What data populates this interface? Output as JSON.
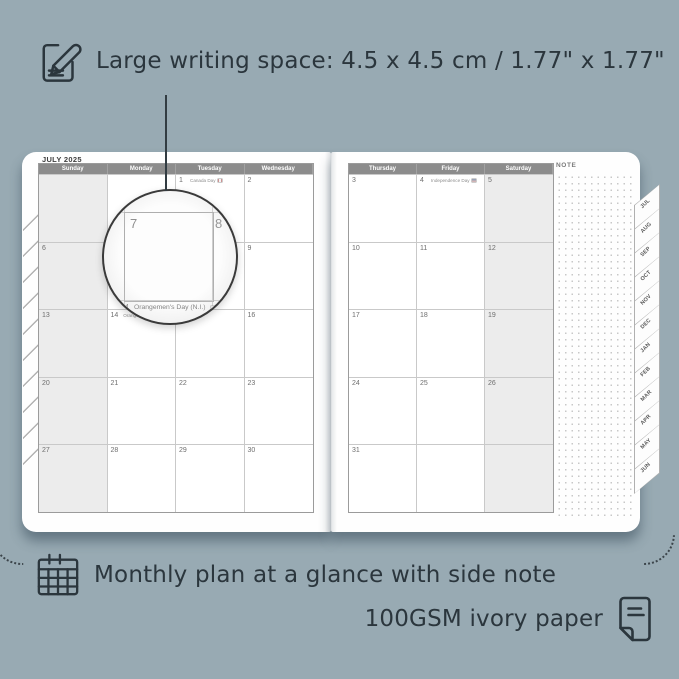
{
  "colors": {
    "background": "#98aab3",
    "ink": "#2b363d",
    "calendar_header_gray": "#8c8c8c",
    "weekend_shade": "#ececec",
    "page_white": "#fefefe"
  },
  "annotations": {
    "top": "Large writing space: 4.5 x 4.5 cm / 1.77\" x 1.77\"",
    "bottom_line1": "Monthly plan at a glance with side note",
    "bottom_line2": "100GSM ivory paper"
  },
  "icons": {
    "top": "note-pencil-icon",
    "bottom_left": "calendar-grid-icon",
    "bottom_right": "paper-icon"
  },
  "planner": {
    "left_page": {
      "title": "JULY 2025",
      "headers": [
        "Sunday",
        "Monday",
        "Tuesday",
        "Wednesday"
      ],
      "shaded_column": 0,
      "rows": [
        [
          {
            "day": ""
          },
          {
            "day": ""
          },
          {
            "day": "1",
            "holiday": "Canada Day",
            "holiday_icon": "canada-flag-icon"
          },
          {
            "day": "2"
          }
        ],
        [
          {
            "day": "6"
          },
          {
            "day": "7"
          },
          {
            "day": "8"
          },
          {
            "day": "9"
          }
        ],
        [
          {
            "day": "13"
          },
          {
            "day": "14",
            "holiday": "Orangemen's Day (N.I.)",
            "holiday_icon": "flag-icon"
          },
          {
            "day": "15"
          },
          {
            "day": "16"
          }
        ],
        [
          {
            "day": "20"
          },
          {
            "day": "21"
          },
          {
            "day": "22"
          },
          {
            "day": "23"
          }
        ],
        [
          {
            "day": "27"
          },
          {
            "day": "28"
          },
          {
            "day": "29"
          },
          {
            "day": "30"
          }
        ]
      ]
    },
    "right_page": {
      "headers": [
        "Thursday",
        "Friday",
        "Saturday"
      ],
      "shaded_column": 2,
      "note_label": "NOTE",
      "rows": [
        [
          {
            "day": "3"
          },
          {
            "day": "4",
            "holiday": "Independence Day",
            "holiday_icon": "us-flag-icon"
          },
          {
            "day": "5"
          }
        ],
        [
          {
            "day": "10"
          },
          {
            "day": "11"
          },
          {
            "day": "12"
          }
        ],
        [
          {
            "day": "17"
          },
          {
            "day": "18"
          },
          {
            "day": "19"
          }
        ],
        [
          {
            "day": "24"
          },
          {
            "day": "25"
          },
          {
            "day": "26"
          }
        ],
        [
          {
            "day": "31"
          },
          {
            "day": ""
          },
          {
            "day": ""
          }
        ]
      ],
      "tabs": [
        "JUL",
        "AUG",
        "SEP",
        "OCT",
        "NOV",
        "DEC",
        "JAN",
        "FEB",
        "MAR",
        "APR",
        "MAY",
        "JUN"
      ]
    },
    "magnifier": {
      "day_left": "7",
      "day_right": "8",
      "bottom_day": "4",
      "bottom_text": "Orangemen's Day (N.I.)"
    }
  }
}
